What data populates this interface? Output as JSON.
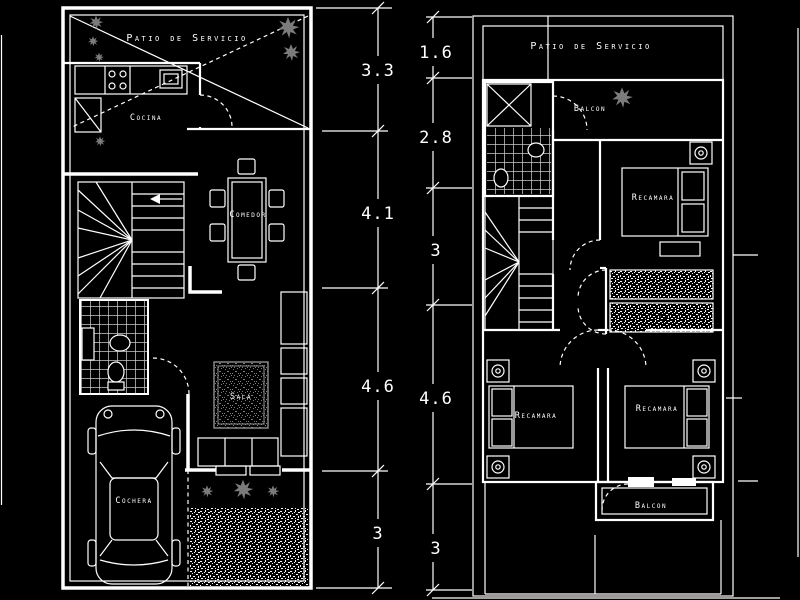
{
  "drawing": {
    "type": "architectural-floor-plan",
    "colors": {
      "background": "#000000",
      "line": "#ffffff",
      "foliage": "#7b7b7b",
      "tile": "#c9c9c9"
    },
    "ground_floor": {
      "patio_label": "Patio de Servicio",
      "cocina_label": "Cocina",
      "comedor_label": "Comedor",
      "sala_label": "Sala",
      "cochera_label": "Cochera"
    },
    "upper_floor": {
      "patio_label": "Patio de Servicio",
      "balcon_upper_label": "Balcon",
      "recamara_top_label": "Recamara",
      "recamara_left_label": "Recamara",
      "recamara_right_label": "Recamara",
      "closet_top_label": "CL",
      "closet_bottom_label": "CL",
      "balcon_lower_label": "Balcon"
    },
    "dimensions": {
      "left_chain": [
        "3.3",
        "4.1",
        "4.6",
        "3"
      ],
      "right_chain": [
        "1.6",
        "2.8",
        "3",
        "4.6",
        "3"
      ]
    }
  }
}
